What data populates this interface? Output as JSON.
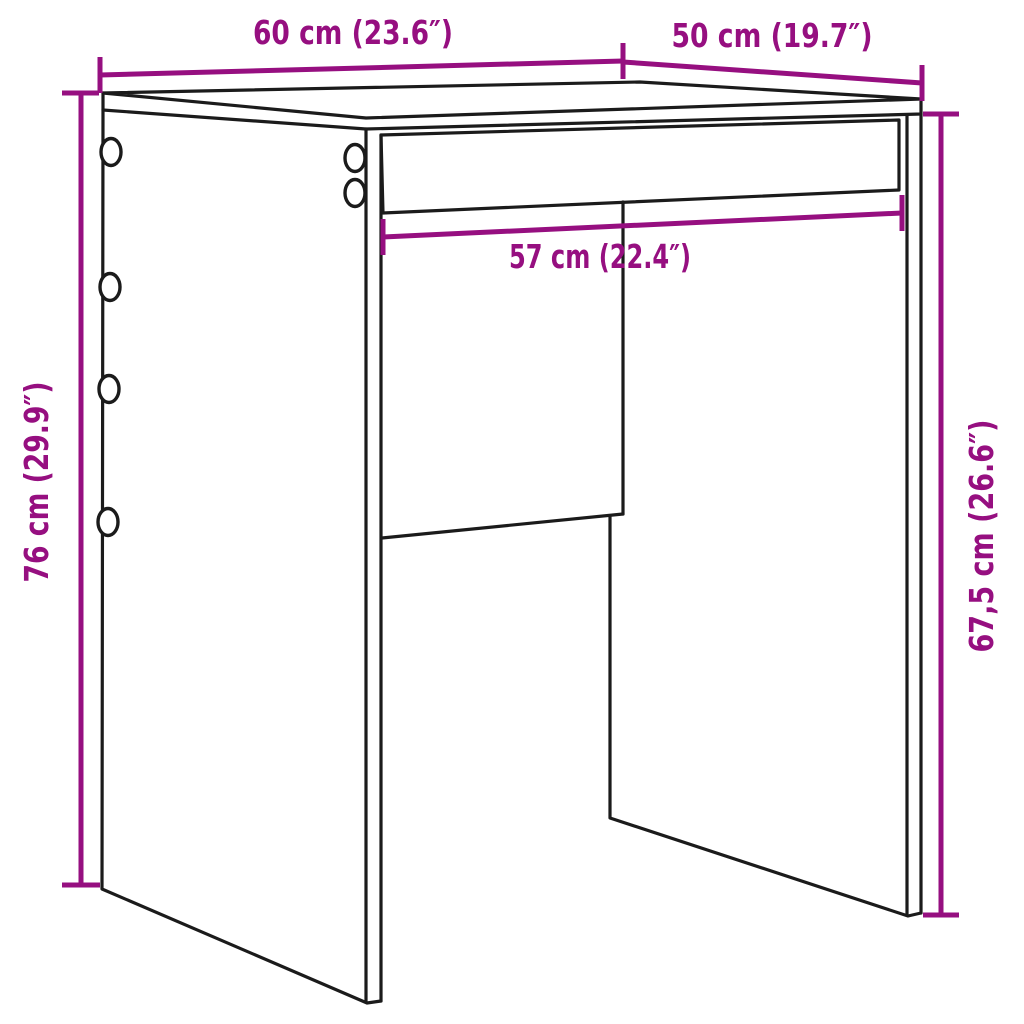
{
  "colors": {
    "outline": "#1b1b1b",
    "dimension": "#960f80",
    "background": "#ffffff"
  },
  "labels": {
    "width": "60 cm (23.6″)",
    "depth": "50 cm (19.7″)",
    "inner_width": "57 cm (22.4″)",
    "height": "76 cm (29.9″)",
    "side_height": "67,5 cm (26.6″)"
  }
}
